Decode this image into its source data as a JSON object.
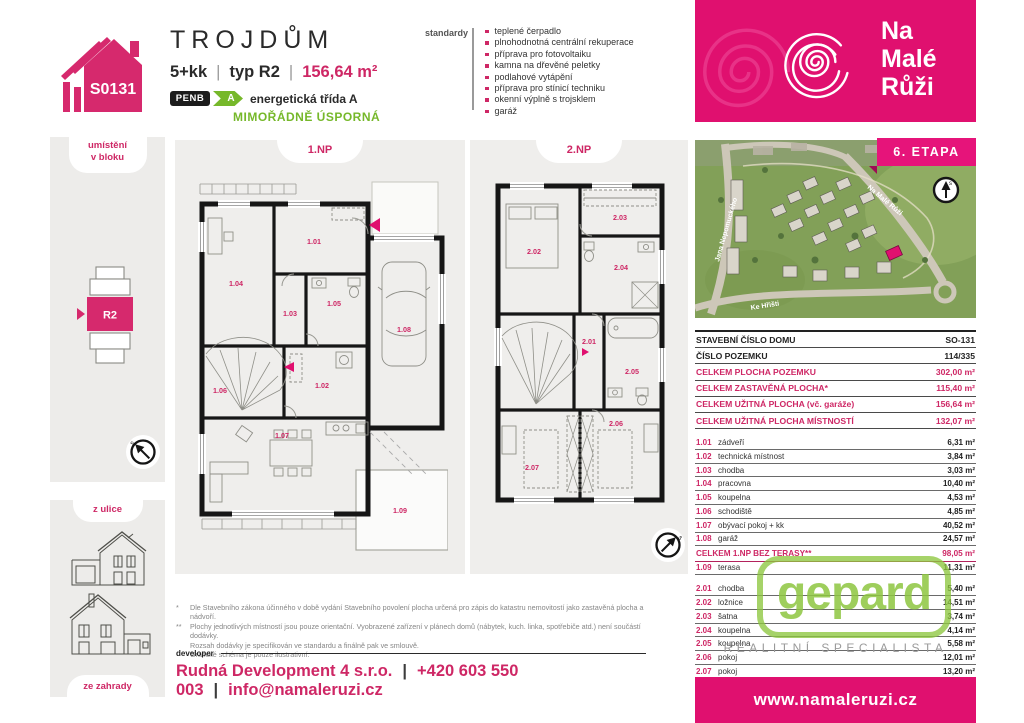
{
  "colors": {
    "brand_pink": "#e0106f",
    "brand_pink_dark": "#9e0b55",
    "pink_text": "#ce2765",
    "penb_green": "#76b82a",
    "gepard_green": "#8dc63f",
    "panel_gray": "#edecea",
    "ink": "#222222"
  },
  "header": {
    "house_code": "S0131",
    "title": "TROJDŮM",
    "disposition": "5+kk",
    "sep": "|",
    "type_label": "typ R2",
    "area": "156,64 m²",
    "penb_label": "PENB",
    "penb_class": "A",
    "energy_class": "energetická třída A",
    "energy_note": "MIMOŘÁDNĚ ÚSPORNÁ",
    "standards_label": "standardy",
    "standards": [
      "teplené čerpadlo",
      "plnohodnotná centrální rekuperace",
      "příprava pro fotovoltaiku",
      "kamna na dřevěné peletky",
      "podlahové vytápění",
      "příprava pro stínicí techniku",
      "okenní výplně s trojsklem",
      "garáž"
    ]
  },
  "brand": {
    "line1": "Na",
    "line2": "Malé",
    "line3": "Růži"
  },
  "sidebar": {
    "location_line1": "umístění",
    "location_line2": "v bloku",
    "unit_label": "R2",
    "street_view_label": "z ulice",
    "garden_view_label": "ze zahrady",
    "compass_letter": "s"
  },
  "floorplans": {
    "floor1": {
      "label": "1.NP",
      "rooms": {
        "entry": "1.01",
        "tech": "1.02",
        "hall": "1.03",
        "study": "1.04",
        "bath": "1.05",
        "stairs": "1.06",
        "living": "1.07",
        "garage": "1.08",
        "terrace": "1.09"
      }
    },
    "floor2": {
      "label": "2.NP",
      "rooms": {
        "hall": "2.01",
        "bedroom": "2.02",
        "closet": "2.03",
        "bath1": "2.04",
        "bath2": "2.05",
        "room1": "2.06",
        "room2": "2.07"
      }
    }
  },
  "site_map": {
    "etapa": "6. ETAPA",
    "streets": [
      "Jana Nepomuckého",
      "Na Malé Růži",
      "Ke Hřišti"
    ],
    "compass_letter": "s"
  },
  "table": {
    "info_rows": [
      {
        "label": "STAVEBNÍ ČÍSLO DOMU",
        "value": "SO-131"
      },
      {
        "label": "ČÍSLO POZEMKU",
        "value": "114/335"
      }
    ],
    "total_rows": [
      {
        "label": "CELKEM PLOCHA POZEMKU",
        "value": "302,00 m²"
      },
      {
        "label": "CELKEM ZASTAVĚNÁ PLOCHA*",
        "value": "115,40 m²"
      },
      {
        "label": "CELKEM UŽITNÁ PLOCHA (vč. garáže)",
        "value": "156,64 m²"
      },
      {
        "label": "CELKEM UŽITNÁ PLOCHA MÍSTNOSTÍ",
        "value": "132,07 m²"
      }
    ],
    "rooms_1np": [
      {
        "num": "1.01",
        "name": "zádveří",
        "area": "6,31 m²"
      },
      {
        "num": "1.02",
        "name": "technická místnost",
        "area": "3,84 m²"
      },
      {
        "num": "1.03",
        "name": "chodba",
        "area": "3,03 m²"
      },
      {
        "num": "1.04",
        "name": "pracovna",
        "area": "10,40 m²"
      },
      {
        "num": "1.05",
        "name": "koupelna",
        "area": "4,53 m²"
      },
      {
        "num": "1.06",
        "name": "schodiště",
        "area": "4,85 m²"
      },
      {
        "num": "1.07",
        "name": "obývací pokoj + kk",
        "area": "40,52 m²"
      },
      {
        "num": "1.08",
        "name": "garáž",
        "area": "24,57 m²"
      }
    ],
    "subtotal_1np": {
      "label": "CELKEM 1.NP BEZ TERASY**",
      "value": "98,05 m²"
    },
    "terrace_row": {
      "num": "1.09",
      "name": "terasa",
      "area": "11,31 m²"
    },
    "rooms_2np": [
      {
        "num": "2.01",
        "name": "chodba",
        "area": "5,40 m²"
      },
      {
        "num": "2.02",
        "name": "ložnice",
        "area": "14,51 m²"
      },
      {
        "num": "2.03",
        "name": "šatna",
        "area": "3,74 m²"
      },
      {
        "num": "2.04",
        "name": "koupelna",
        "area": "4,14 m²"
      },
      {
        "num": "2.05",
        "name": "koupelna",
        "area": "5,58 m²"
      },
      {
        "num": "2.06",
        "name": "pokoj",
        "area": "12,01 m²"
      },
      {
        "num": "2.07",
        "name": "pokoj",
        "area": "13,20 m²"
      }
    ],
    "subtotal_2np": {
      "label": "CELKEM 2.NP**",
      "value": "58,58 m²"
    }
  },
  "gepard": {
    "logo": "gepard",
    "tagline": "REALITNÍ SPECIALISTA"
  },
  "footer": {
    "note1_marker": "*",
    "note1": "Dle Stavebního zákona účinného v době vydání Stavebního povolení plocha určená pro zápis do katastru nemovitostí jako zastavěná plocha a nádvoří.",
    "note2_marker": "**",
    "note2": "Plochy jednotlivých místností jsou pouze orientační. Vyobrazené zařízení v plánech domů (nábytek, kuch. linka, spotřebiče atd.) není součástí dodávky.",
    "note3": "Rozsah dodávky je specifikován ve standardu a finálně pak ve smlouvě.",
    "note4": "Grafické schéma je pouze ilustrativní.",
    "developer_label": "developer",
    "developer_name": "Rudná Development 4 s.r.o.",
    "separator": "|",
    "phone": "+420 603 550 003",
    "email": "info@namaleruzi.cz",
    "website": "www.namaleruzi.cz"
  }
}
